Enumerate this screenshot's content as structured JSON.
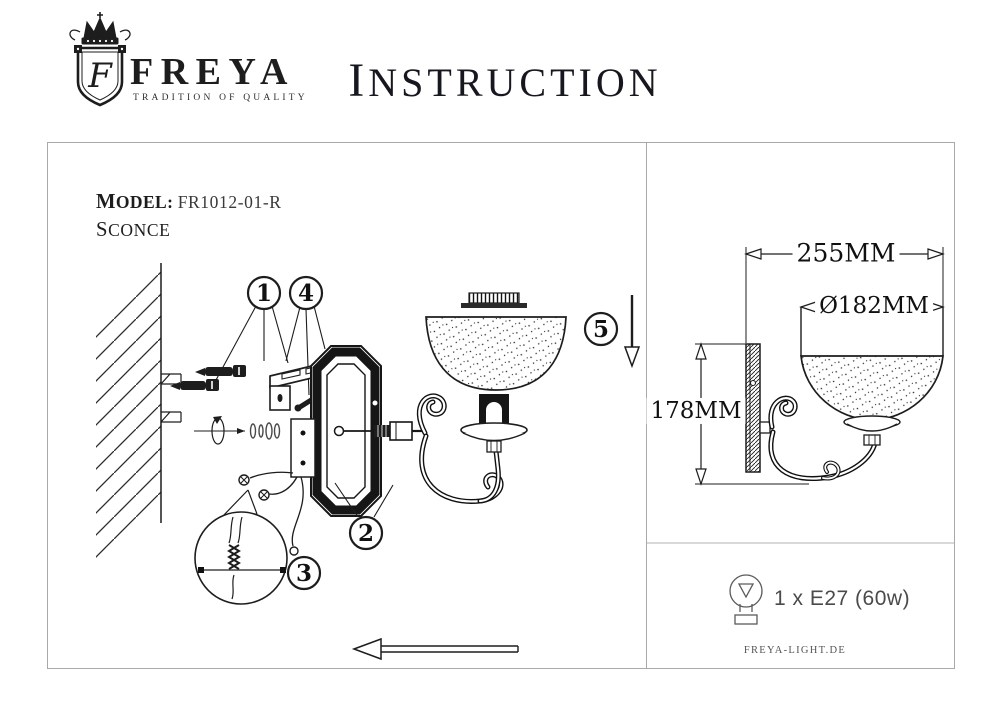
{
  "header": {
    "brand": "FREYA",
    "tagline": "TRADITION OF QUALITY",
    "monogram": "F",
    "title": "INSTRUCTION"
  },
  "model": {
    "label": "MODEL:",
    "value": "FR1012-01-R",
    "type": "SCONCE"
  },
  "callouts": {
    "c1": "1",
    "c2": "2",
    "c3": "3",
    "c4": "4",
    "c5": "5"
  },
  "dimensions": {
    "width": "255MM",
    "diameter": "Ø182MM",
    "height": "178MM"
  },
  "spec": {
    "bulb": "1 x E27 (60w)",
    "website": "FREYA-LIGHT.DE"
  },
  "colors": {
    "ink": "#1d1d1d",
    "panel_border": "#a9a9a9"
  }
}
